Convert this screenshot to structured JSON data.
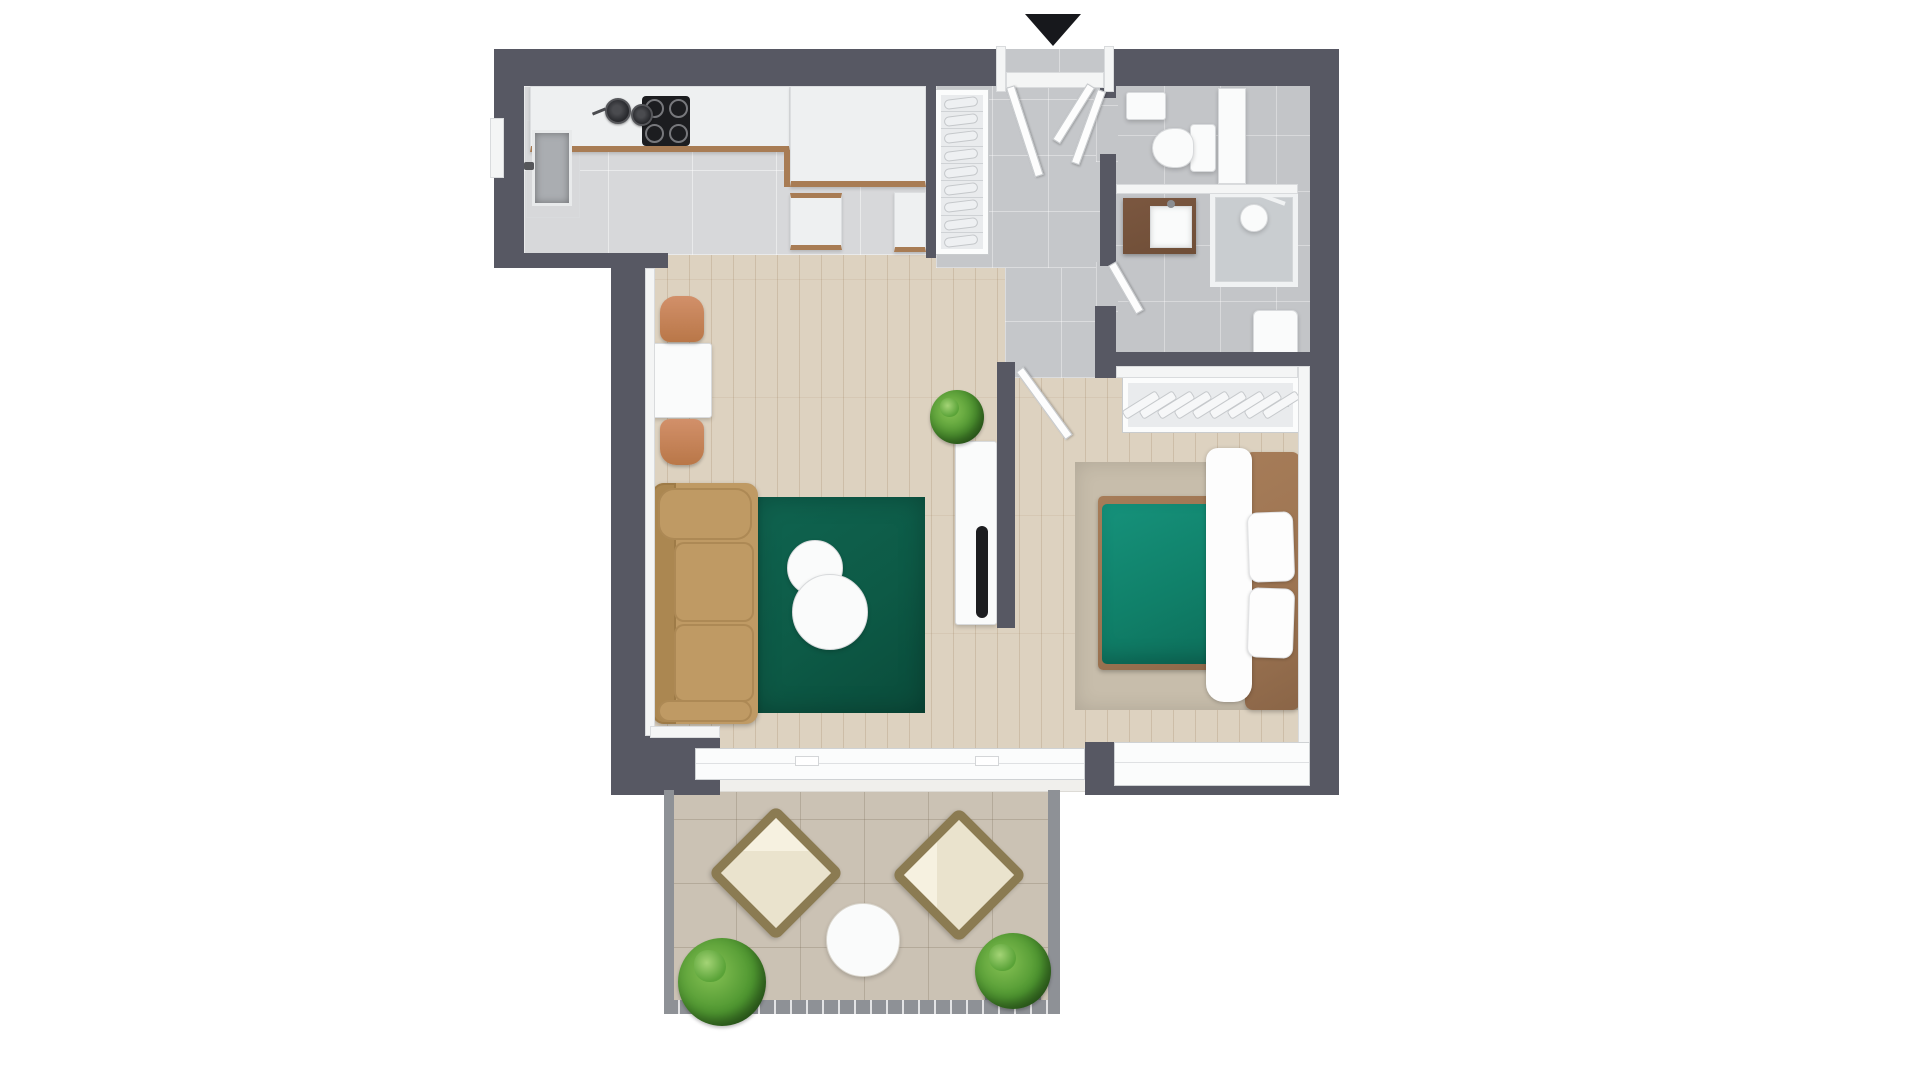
{
  "scene": {
    "type": "apartment-floor-plan",
    "view": "top-down-3d-render",
    "canvas": {
      "width": 1920,
      "height": 1080
    }
  },
  "palette": {
    "wall": "#575863",
    "wall_inner": "#f4f5f5",
    "kitchen_tile": "#d7d8da",
    "hall_tile": "#c5c7ca",
    "bath_tile": "#c3c5c8",
    "wood": "#ddd2c0",
    "terrace_tile": "#cbc2b4",
    "railing": "#8e9196",
    "rug": "#0d5a46",
    "duvet": "#108069",
    "bed_rug": "#c7bdab",
    "sofa": "#bf9a64",
    "chair": "#c8855a",
    "frame_brown": "#9b7351",
    "counter_edge": "#a87c54",
    "vanity": "#6f4e37",
    "black": "#1c1d20",
    "white": "#fafbfb",
    "plant": "#4e9630",
    "plant_dark": "#2e661d",
    "plant_light": "#86c254",
    "cream": "#eae3cd",
    "wicker": "#8b7b52",
    "pot_gray": "#73767b",
    "marker": "#17181c"
  },
  "entrance": {
    "marker_icon": "triangle-down",
    "position": "top-center"
  },
  "rooms": [
    {
      "id": "kitchen",
      "furniture": [
        "kitchen-counter",
        "induction-cooktop",
        "cookware-pots",
        "kitchen-sink",
        "island-cabinet"
      ]
    },
    {
      "id": "hallway",
      "furniture": [
        "shoe-rack",
        "entrance-double-door"
      ]
    },
    {
      "id": "toilet-room",
      "furniture": [
        "toilet",
        "wall-cabinet",
        "tall-cabinet"
      ]
    },
    {
      "id": "bathroom",
      "furniture": [
        "vanity-with-sink",
        "shower-cabin",
        "washing-machine",
        "door"
      ]
    },
    {
      "id": "living-room",
      "furniture": [
        "dining-table",
        "dining-chairs",
        "three-seat-sofa",
        "green-rug",
        "round-coffee-tables",
        "tv-sideboard",
        "tv",
        "potted-plant"
      ]
    },
    {
      "id": "bedroom",
      "furniture": [
        "open-wardrobe-with-hangers",
        "double-bed",
        "pillows",
        "area-rug",
        "door",
        "window"
      ]
    },
    {
      "id": "terrace",
      "furniture": [
        "lounge-chairs",
        "round-side-table",
        "potted-plants",
        "railing"
      ]
    }
  ],
  "counts": {
    "shoe_rack_shelves": 9,
    "wardrobe_hangers": 9,
    "cooktop_burners": 4,
    "entrance_door_leaves": 2,
    "interior_door_leaves": 3,
    "coffee_tables": 2,
    "pillows": 2,
    "terrace_loungers": 2,
    "terrace_plants": 2
  }
}
